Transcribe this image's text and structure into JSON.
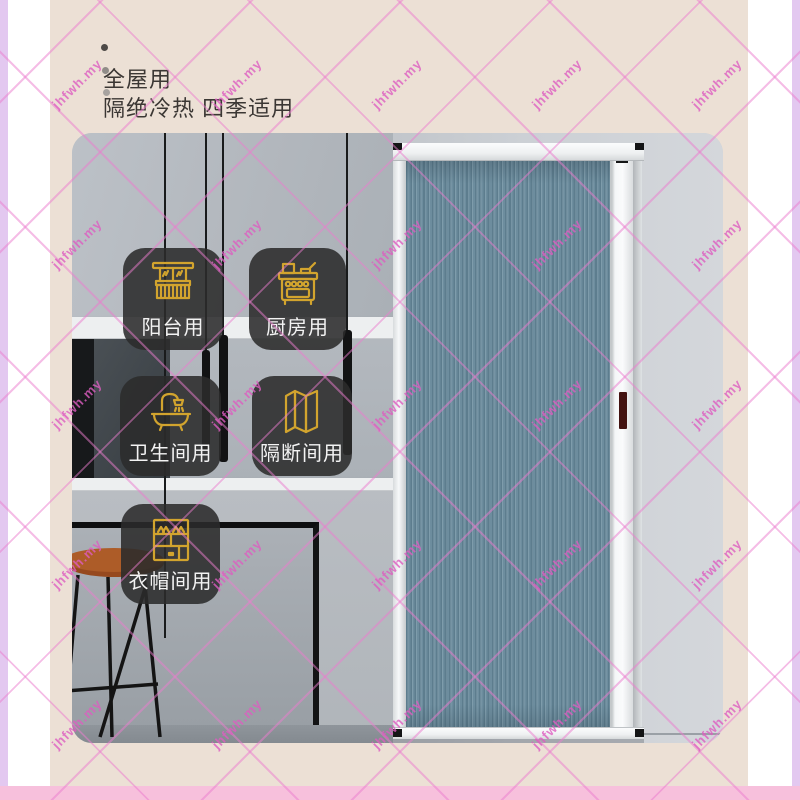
{
  "title": {
    "line1": "全屋用",
    "line2": "隔绝冷热 四季适用"
  },
  "usage_badges": [
    {
      "label": "阳台用",
      "icon": "balcony-icon"
    },
    {
      "label": "厨房用",
      "icon": "kitchen-stove-icon"
    },
    {
      "label": "卫生间用",
      "icon": "bathtub-icon"
    },
    {
      "label": "隔断间用",
      "icon": "folding-screen-icon"
    },
    {
      "label": "衣帽间用",
      "icon": "wardrobe-icon"
    }
  ],
  "watermark": {
    "text": "jhfwh.my"
  },
  "colors": {
    "canvas_beige": "#ece0d5",
    "side_strip_purple": "#e3c8f0",
    "bottom_bar_pink": "#f7c0dc",
    "watermark_pink": "#e87cce",
    "badge_background": "rgba(43,43,43,0.88)",
    "icon_gold": "#d2a42e",
    "door_pleat_blue_gray": "#6d8d9e",
    "door_frame_white": "#f5f7f8",
    "handle_maroon": "#431311"
  }
}
